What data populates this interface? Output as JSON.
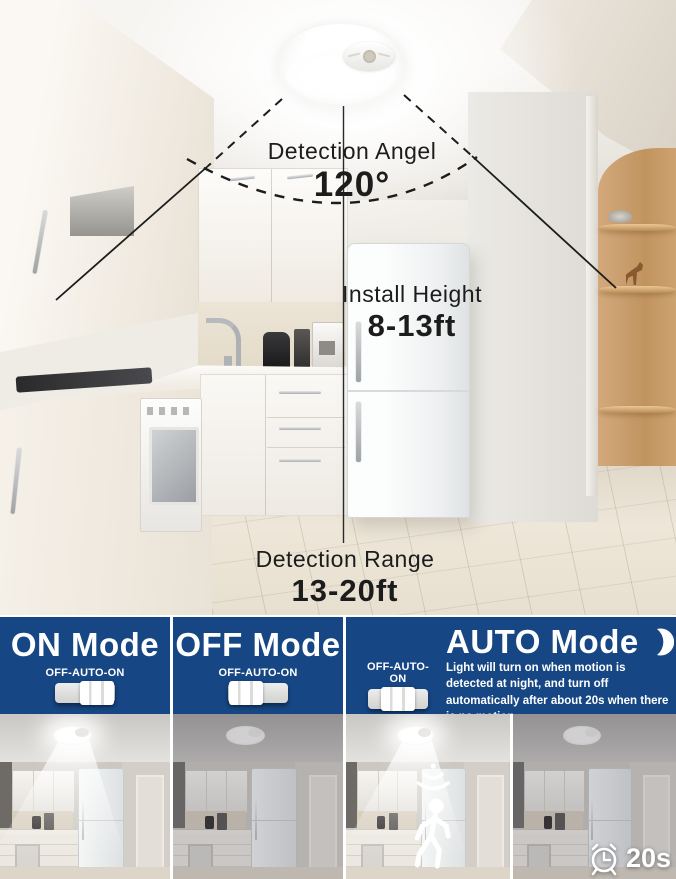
{
  "hero": {
    "light_name": "motion-sensor-ceiling-light",
    "detection_angle": {
      "label": "Detection Angel",
      "value": "120°"
    },
    "install_height": {
      "label": "Install Height",
      "value": "8-13ft"
    },
    "detection_range": {
      "label": "Detection Range",
      "value": "13-20ft"
    }
  },
  "modes": {
    "on": {
      "title": "ON Mode",
      "switch_label": "OFF-AUTO-ON",
      "switch_position": "on",
      "light_state": "on"
    },
    "off": {
      "title": "OFF Mode",
      "switch_label": "OFF-AUTO-ON",
      "switch_position": "off",
      "light_state": "off"
    },
    "auto": {
      "title": "AUTO Mode",
      "moon_icon": "moon-icon",
      "switch_label": "OFF-AUTO-ON",
      "switch_position": "auto",
      "description": "Light will turn on when motion is detected at night, and turn off automatically after about 20s when there is no motion.",
      "motion_icons": [
        "motion-waves-icon",
        "walking-person-icon"
      ],
      "timer_icon": "alarm-clock-icon",
      "auto_off_time": "20s",
      "light_state_motion": "on",
      "light_state_no_motion": "off"
    }
  },
  "colors": {
    "header_blue": "#164684",
    "header_text": "#ffffff",
    "annotation_ink": "#1c1c1c"
  }
}
